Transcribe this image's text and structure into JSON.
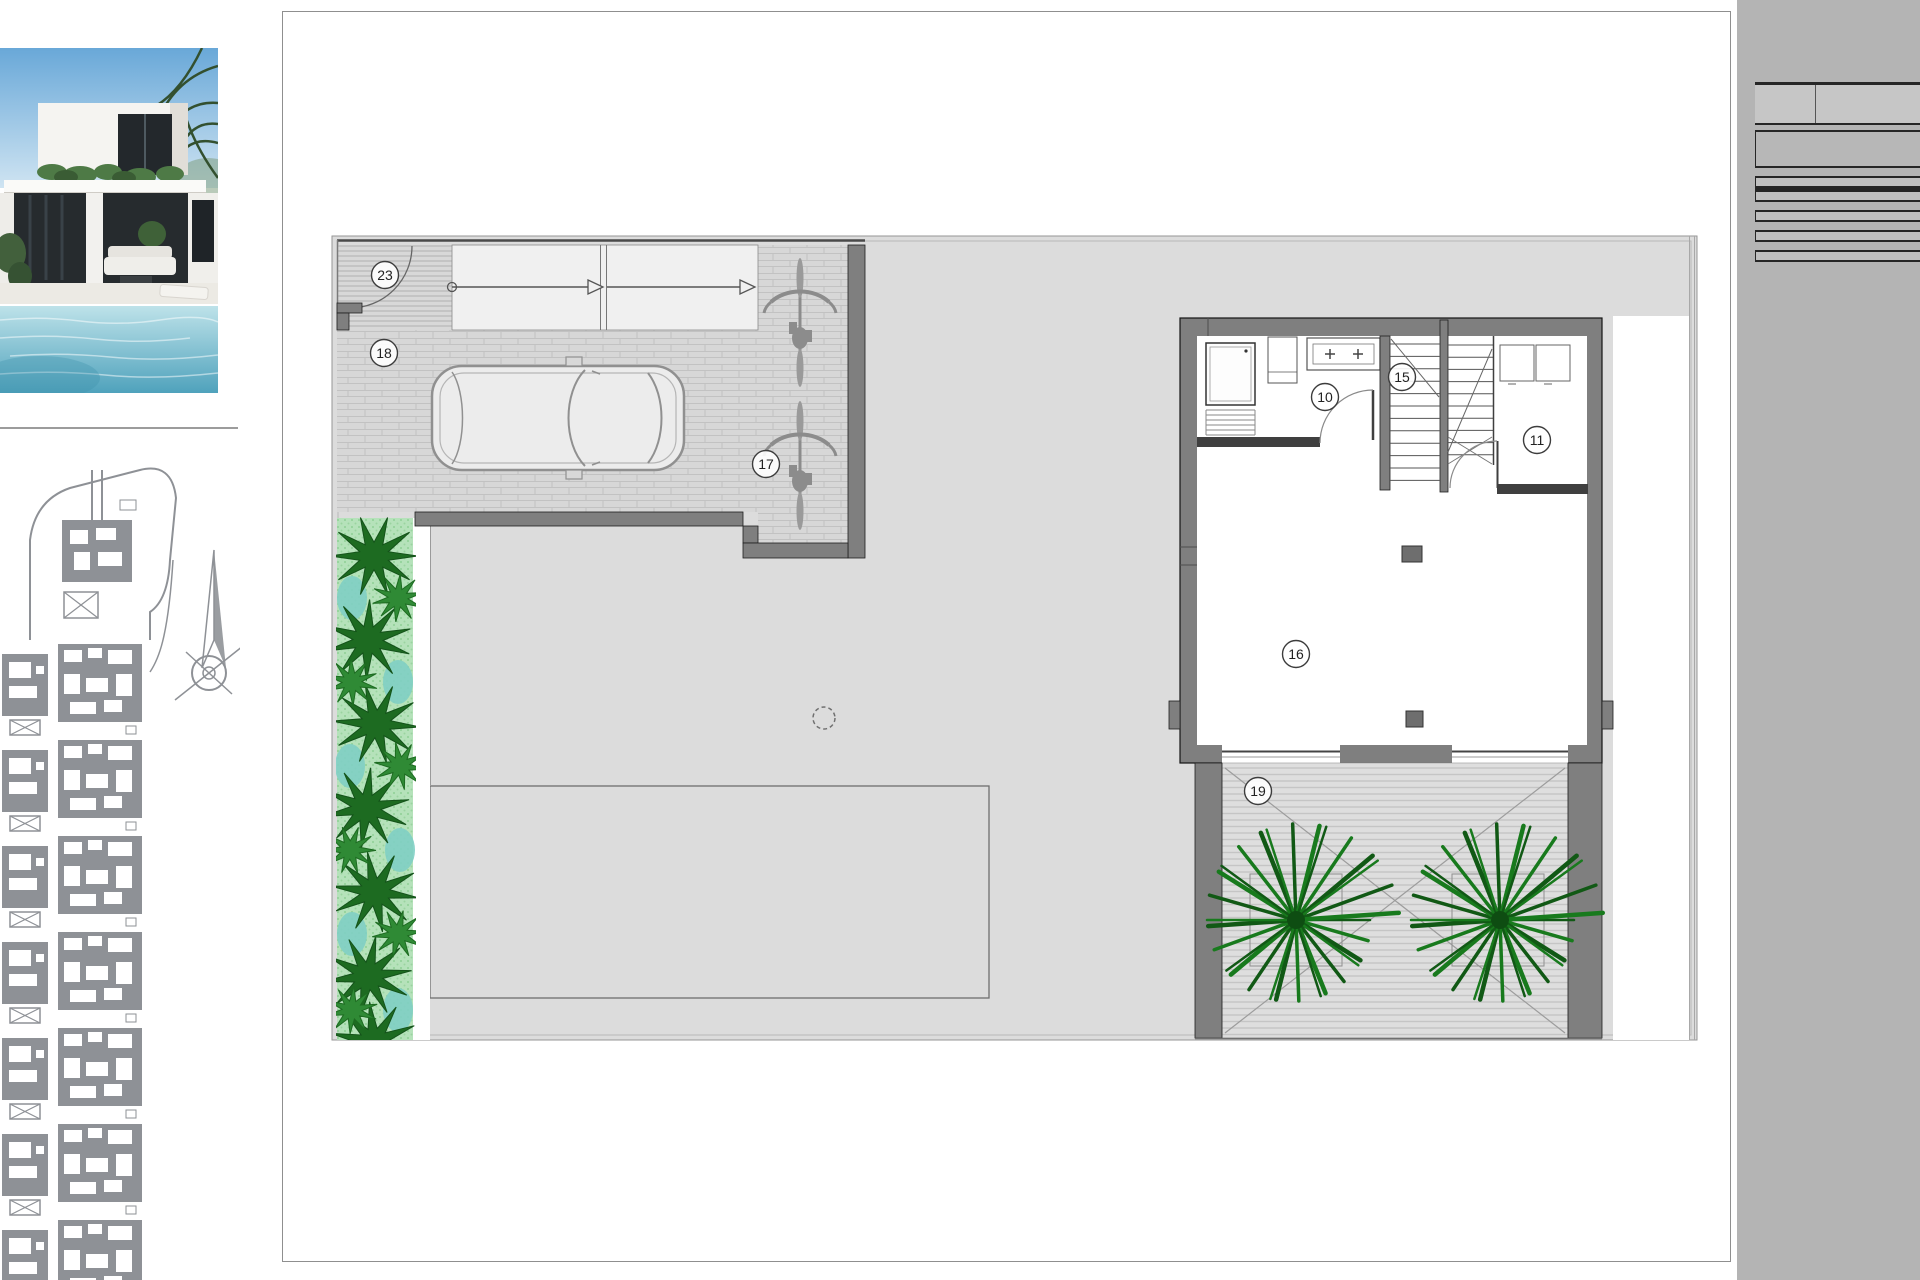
{
  "watermark": {
    "text": "www.rayosdesol.com"
  },
  "colors": {
    "panel_gray": "#b4b4b4",
    "parcel_gray": "#dcdcdc",
    "wall_gray": "#7f7f7f",
    "hedge_green_dark": "#1d6b21",
    "hedge_green_light": "#b5e2ba",
    "palm_green": "#187a1d",
    "pool_blue": "#58aec6"
  },
  "plan": {
    "labels": [
      {
        "n": "23",
        "x": 385,
        "y": 275
      },
      {
        "n": "18",
        "x": 384,
        "y": 353
      },
      {
        "n": "17",
        "x": 766,
        "y": 464
      },
      {
        "n": "10",
        "x": 1325,
        "y": 397
      },
      {
        "n": "15",
        "x": 1402,
        "y": 377
      },
      {
        "n": "11",
        "x": 1537,
        "y": 440
      },
      {
        "n": "16",
        "x": 1296,
        "y": 654
      },
      {
        "n": "19",
        "x": 1258,
        "y": 791
      }
    ]
  },
  "schedule": {
    "header": {
      "num": "nº",
      "label": "SUPERFICIE ÚTI"
    },
    "rooms": [
      {
        "num": "1",
        "lines": [
          "SALÓN-COMED",
          "LIVING-DINING"
        ]
      },
      {
        "num": "2",
        "lines": [
          "DORMITORIO 1"
        ]
      },
      {
        "num": "3",
        "lines": [
          "DORMITORIO 2"
        ]
      },
      {
        "num": "4",
        "lines": [
          "DORMITORIO 3"
        ]
      },
      {
        "num": "5",
        "lines": [
          "DORMITORIO 4"
        ]
      },
      {
        "num": "6",
        "lines": [
          "ALMACÉN 1 / ST"
        ]
      },
      {
        "num": "7",
        "lines": [
          "BAÑO 1 / BATH"
        ]
      },
      {
        "num": "8",
        "lines": [
          "BAÑO 2 / BATH"
        ]
      },
      {
        "num": "9",
        "lines": [
          "BAÑO 3 / BATH"
        ]
      },
      {
        "num": "10",
        "lines": [
          "BAÑO 4 / BATH"
        ]
      },
      {
        "num": "11",
        "lines": [
          "LAVADERO / LA"
        ]
      },
      {
        "num": "12",
        "lines": [
          "PASO 1/ CORRI"
        ]
      },
      {
        "num": "13",
        "lines": [
          "PASO 2/ CORRI"
        ]
      },
      {
        "num": "14",
        "lines": [
          "ESCALERA 1 / ST"
        ]
      },
      {
        "num": "15",
        "lines": [
          "ESCALERA 2 / ST"
        ]
      },
      {
        "num": "16",
        "lines": [
          "TRASTERO / STO"
        ]
      }
    ],
    "interior_header_lines": [
      "SUP CONSTRUIDA IN",
      "INTERIOR A"
    ],
    "built": [
      {
        "num": "17",
        "lines": [
          "SUP CONSTRUI",
          "BUILT GARAGE"
        ]
      },
      {
        "num": "18",
        "lines": [
          "SUP GARAGE/ G"
        ]
      },
      {
        "num": "19",
        "lines": [
          "SUP CONSTRUI",
          "DESCUBIERTA 1",
          "TERRACE AREA"
        ]
      },
      {
        "num": "20",
        "lines": [
          "SUP CONSTRUI",
          "DESCUBIERTA 2",
          "TERRACE AREA"
        ]
      },
      {
        "num": "21",
        "lines": [
          "SUP CONSTRUI",
          "DESCUBIERTA 3",
          "TERRACE AREA"
        ]
      },
      {
        "num": "22",
        "lines": [
          "SUP CONSTRUI",
          "DESCUBIERTA 4",
          "TERRACE AREA"
        ]
      },
      {
        "num": "23",
        "lines": [
          "ACCESO / ACCE"
        ]
      }
    ],
    "total_lines": [
      "TOTAL SUP CONSTRUIDA",
      "BUILT PRIVATE"
    ],
    "pool_label": "PISCINA / SWIMM",
    "garden_label": "SUP. JARDÍN / GAR",
    "plot_label": "SUPERFICE PARCELA"
  }
}
